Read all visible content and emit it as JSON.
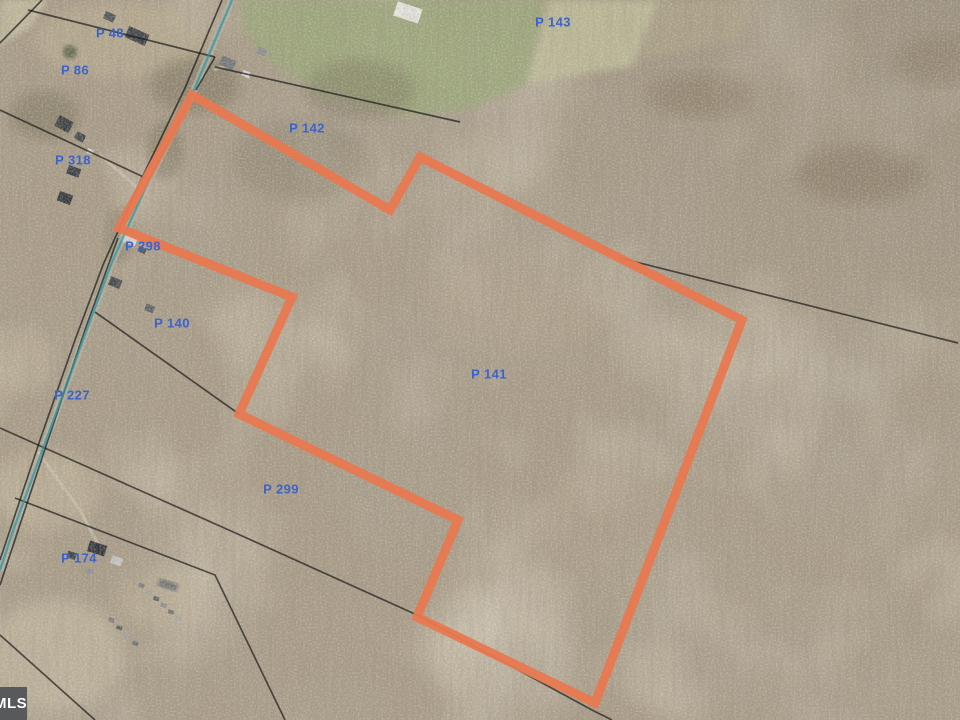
{
  "map": {
    "description": "Aerial parcel map with highlighted wooded lot",
    "watermark": {
      "text": "MLS"
    },
    "label_color": "#3b63cf",
    "parcel_labels": [
      {
        "text": "P 48",
        "x": 110,
        "y": 33
      },
      {
        "text": "P 86",
        "x": 75,
        "y": 70
      },
      {
        "text": "P 143",
        "x": 553,
        "y": 22
      },
      {
        "text": "P 142",
        "x": 307,
        "y": 128
      },
      {
        "text": "P 318",
        "x": 73,
        "y": 160
      },
      {
        "text": "P 298",
        "x": 143,
        "y": 246
      },
      {
        "text": "P 140",
        "x": 172,
        "y": 323
      },
      {
        "text": "P 227",
        "x": 72,
        "y": 395
      },
      {
        "text": "P 141",
        "x": 489,
        "y": 374
      },
      {
        "text": "P 299",
        "x": 281,
        "y": 489
      },
      {
        "text": "P 174",
        "x": 79,
        "y": 558
      }
    ],
    "highlighted_parcel": {
      "name": "P 141",
      "color": "#e87850",
      "stroke_width": 9,
      "vertices": [
        [
          192,
          95
        ],
        [
          390,
          210
        ],
        [
          420,
          157
        ],
        [
          742,
          320
        ],
        [
          595,
          703
        ],
        [
          417,
          617
        ],
        [
          458,
          520
        ],
        [
          239,
          414
        ],
        [
          292,
          297
        ],
        [
          119,
          228
        ]
      ]
    },
    "boundary_lines": {
      "color": "#161616",
      "lines": [
        [
          [
            42,
            0
          ],
          [
            0,
            43
          ]
        ],
        [
          [
            28,
            10
          ],
          [
            215,
            57
          ]
        ],
        [
          [
            215,
            57
          ],
          [
            196,
            90
          ]
        ],
        [
          [
            222,
            0
          ],
          [
            185,
            88
          ],
          [
            140,
            182
          ],
          [
            103,
            265
          ],
          [
            75,
            340
          ],
          [
            40,
            440
          ],
          [
            0,
            560
          ]
        ],
        [
          [
            215,
            67
          ],
          [
            460,
            122
          ]
        ],
        [
          [
            620,
            258
          ],
          [
            958,
            343
          ]
        ],
        [
          [
            0,
            110
          ],
          [
            150,
            180
          ]
        ],
        [
          [
            95,
            312
          ],
          [
            239,
            414
          ]
        ],
        [
          [
            0,
            428
          ],
          [
            240,
            535
          ],
          [
            417,
            615
          ],
          [
            592,
            710
          ],
          [
            612,
            720
          ]
        ],
        [
          [
            15,
            498
          ],
          [
            215,
            575
          ],
          [
            285,
            720
          ]
        ],
        [
          [
            118,
            238
          ],
          [
            85,
            330
          ],
          [
            48,
            440
          ],
          [
            0,
            585
          ]
        ],
        [
          [
            0,
            635
          ],
          [
            95,
            720
          ]
        ]
      ]
    },
    "road_line": {
      "color": "#2d9aa3",
      "points": [
        [
          232,
          0
        ],
        [
          194,
          90
        ],
        [
          148,
          182
        ],
        [
          112,
          262
        ],
        [
          86,
          332
        ],
        [
          52,
          424
        ],
        [
          14,
          528
        ],
        [
          0,
          570
        ]
      ]
    }
  }
}
